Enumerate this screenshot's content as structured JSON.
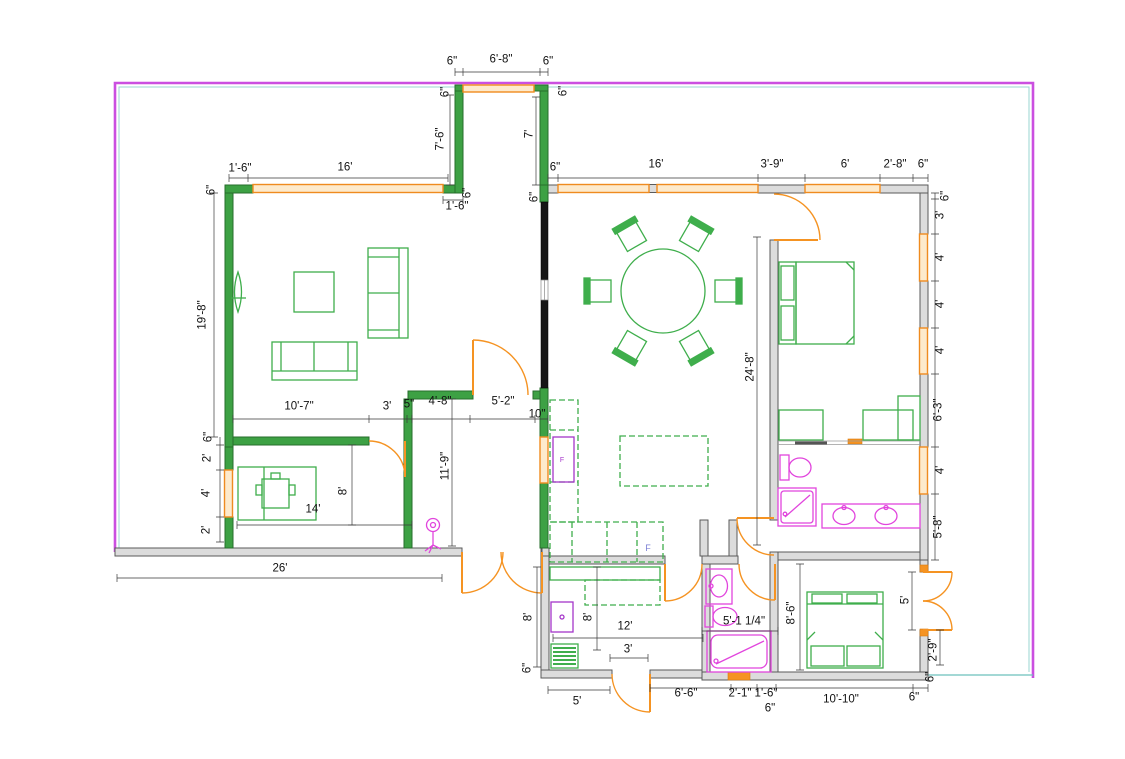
{
  "page": {
    "type": "floor-plan",
    "width": 1125,
    "height": 759
  },
  "colors": {
    "wall_green": "#3da144",
    "wall_green_edge": "#266e2b",
    "wall_gray": "#dcdcdc",
    "wall_gray_edge": "#5a5a5a",
    "wall_black": "#161616",
    "window_orange": "#ef8b1f",
    "window_fill": "#fdeacc",
    "door_orange": "#f59322",
    "furniture_green": "#3fae4c",
    "fixture_magenta": "#e145dd",
    "appliance_purple": "#a435c9",
    "boundary_magenta": "#cb4fe0",
    "boundary_cyan": "#9ad4d0",
    "teal_line": "#6cc0bc",
    "dim_text": "#111111"
  },
  "annotations": {
    "counter_label": "F",
    "fridge_label": "F"
  },
  "dimensions": [
    {
      "t": "6\"",
      "x": 452,
      "y": 62,
      "r": 0
    },
    {
      "t": "6'-8\"",
      "x": 501,
      "y": 60,
      "r": 0
    },
    {
      "t": "6\"",
      "x": 548,
      "y": 62,
      "r": 0
    },
    {
      "t": "6\"",
      "x": 446,
      "y": 92,
      "r": -90
    },
    {
      "t": "6\"",
      "x": 564,
      "y": 91,
      "r": -90
    },
    {
      "t": "7'-6\"",
      "x": 441,
      "y": 139,
      "r": -90
    },
    {
      "t": "7'",
      "x": 530,
      "y": 134,
      "r": -90
    },
    {
      "t": "6\"",
      "x": 468,
      "y": 193,
      "r": -90
    },
    {
      "t": "6\"",
      "x": 535,
      "y": 197,
      "r": -90
    },
    {
      "t": "6\"",
      "x": 555,
      "y": 168,
      "r": 0
    },
    {
      "t": "1'-6\"",
      "x": 240,
      "y": 169,
      "r": 0
    },
    {
      "t": "16'",
      "x": 345,
      "y": 168,
      "r": 0
    },
    {
      "t": "6\"",
      "x": 212,
      "y": 190,
      "r": -90
    },
    {
      "t": "1'-6\"",
      "x": 457,
      "y": 207,
      "r": 0
    },
    {
      "t": "16'",
      "x": 656,
      "y": 165,
      "r": 0
    },
    {
      "t": "3'-9\"",
      "x": 772,
      "y": 165,
      "r": 0
    },
    {
      "t": "6'",
      "x": 845,
      "y": 165,
      "r": 0
    },
    {
      "t": "2'-8\"",
      "x": 895,
      "y": 165,
      "r": 0
    },
    {
      "t": "6\"",
      "x": 923,
      "y": 165,
      "r": 0
    },
    {
      "t": "6\"",
      "x": 946,
      "y": 196,
      "r": -90
    },
    {
      "t": "3'",
      "x": 941,
      "y": 215,
      "r": -90
    },
    {
      "t": "4'",
      "x": 941,
      "y": 257,
      "r": -90
    },
    {
      "t": "4'",
      "x": 941,
      "y": 304,
      "r": -90
    },
    {
      "t": "4'",
      "x": 941,
      "y": 350,
      "r": -90
    },
    {
      "t": "6'-3\"",
      "x": 939,
      "y": 410,
      "r": -90
    },
    {
      "t": "4'",
      "x": 941,
      "y": 470,
      "r": -90
    },
    {
      "t": "5'-8\"",
      "x": 939,
      "y": 527,
      "r": -90
    },
    {
      "t": "19'-8\"",
      "x": 203,
      "y": 315,
      "r": -90
    },
    {
      "t": "6\"",
      "x": 209,
      "y": 437,
      "r": -90
    },
    {
      "t": "2'",
      "x": 208,
      "y": 458,
      "r": -90
    },
    {
      "t": "4'",
      "x": 207,
      "y": 493,
      "r": -90
    },
    {
      "t": "2'",
      "x": 207,
      "y": 530,
      "r": -90
    },
    {
      "t": "10'-7\"",
      "x": 299,
      "y": 407,
      "r": 0
    },
    {
      "t": "3'",
      "x": 387,
      "y": 407,
      "r": 0
    },
    {
      "t": "5\"",
      "x": 409,
      "y": 405,
      "r": 0
    },
    {
      "t": "4'-8\"",
      "x": 440,
      "y": 402,
      "r": 0
    },
    {
      "t": "5'-2\"",
      "x": 503,
      "y": 402,
      "r": 0
    },
    {
      "t": "10\"",
      "x": 537,
      "y": 415,
      "r": 0
    },
    {
      "t": "11'-9\"",
      "x": 446,
      "y": 466,
      "r": -90
    },
    {
      "t": "24'-8\"",
      "x": 751,
      "y": 367,
      "r": -90
    },
    {
      "t": "8'",
      "x": 344,
      "y": 491,
      "r": -90
    },
    {
      "t": "14'",
      "x": 313,
      "y": 510,
      "r": 0
    },
    {
      "t": "26'",
      "x": 280,
      "y": 569,
      "r": 0
    },
    {
      "t": "8'",
      "x": 529,
      "y": 617,
      "r": -90
    },
    {
      "t": "8'",
      "x": 589,
      "y": 617,
      "r": -90
    },
    {
      "t": "12'",
      "x": 625,
      "y": 627,
      "r": 0
    },
    {
      "t": "3'",
      "x": 628,
      "y": 650,
      "r": 0
    },
    {
      "t": "6\"",
      "x": 528,
      "y": 668,
      "r": -90
    },
    {
      "t": "5'",
      "x": 577,
      "y": 702,
      "r": 0
    },
    {
      "t": "6'-6\"",
      "x": 686,
      "y": 694,
      "r": 0
    },
    {
      "t": "2'-1\"",
      "x": 740,
      "y": 694,
      "r": 0
    },
    {
      "t": "1'-6\"",
      "x": 766,
      "y": 694,
      "r": 0
    },
    {
      "t": "6\"",
      "x": 770,
      "y": 709,
      "r": 0
    },
    {
      "t": "10'-10\"",
      "x": 841,
      "y": 700,
      "r": 0
    },
    {
      "t": "6\"",
      "x": 914,
      "y": 698,
      "r": 0
    },
    {
      "t": "5'-1 1/4\"",
      "x": 744,
      "y": 622,
      "r": 0
    },
    {
      "t": "8'-6\"",
      "x": 792,
      "y": 613,
      "r": -90
    },
    {
      "t": "5'",
      "x": 906,
      "y": 600,
      "r": -90
    },
    {
      "t": "2'-9\"",
      "x": 934,
      "y": 650,
      "r": -90
    },
    {
      "t": "6\"",
      "x": 931,
      "y": 677,
      "r": -90
    }
  ]
}
